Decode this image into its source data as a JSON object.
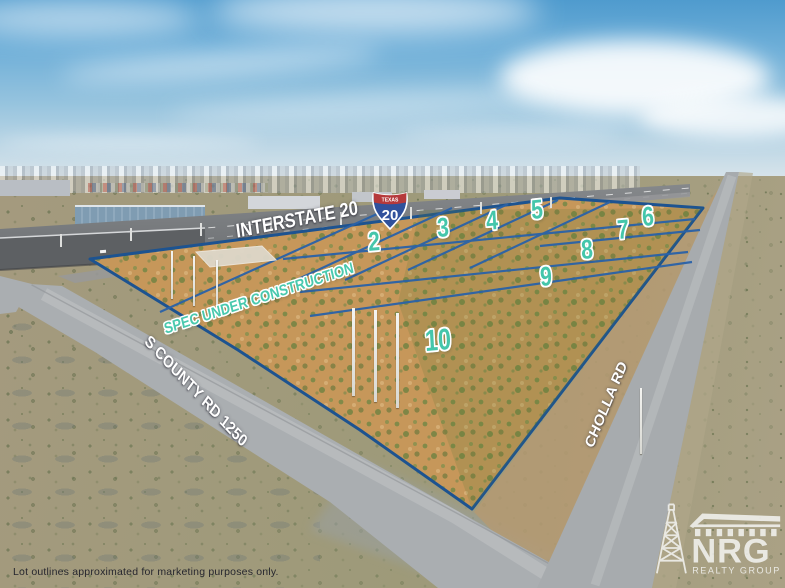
{
  "scene": {
    "description": "Aerial drone photo of commercial land lots for sale beside Interstate 20",
    "sky": "blue with clouds",
    "terrain": "desert scrub with tan dirt lots"
  },
  "labels": {
    "interstate": "INTERSTATE 20",
    "spec": "SPEC UNDER CONSTRUCTION",
    "road_left": "S COUNTY RD 1250",
    "road_right": "CHOLLA RD"
  },
  "shield": {
    "state": "TEXAS",
    "route": "20"
  },
  "lots": [
    {
      "label": "2"
    },
    {
      "label": "3"
    },
    {
      "label": "4"
    },
    {
      "label": "5"
    },
    {
      "label": "6"
    },
    {
      "label": "7"
    },
    {
      "label": "8"
    },
    {
      "label": "9"
    },
    {
      "label": "10"
    }
  ],
  "logo": {
    "name": "NRG",
    "subtitle": "REALTY GROUP"
  },
  "disclaimer": "Lot outlines approximated for marketing purposes only.",
  "colors": {
    "lot_number_teal": "#45c6ab",
    "boundary_navy": "#1d5390",
    "interior_line_blue": "#2a62a8",
    "label_white": "#ffffff",
    "shield_red": "#b5393b",
    "shield_blue": "#30519c",
    "property_tan": "#c6975a"
  }
}
